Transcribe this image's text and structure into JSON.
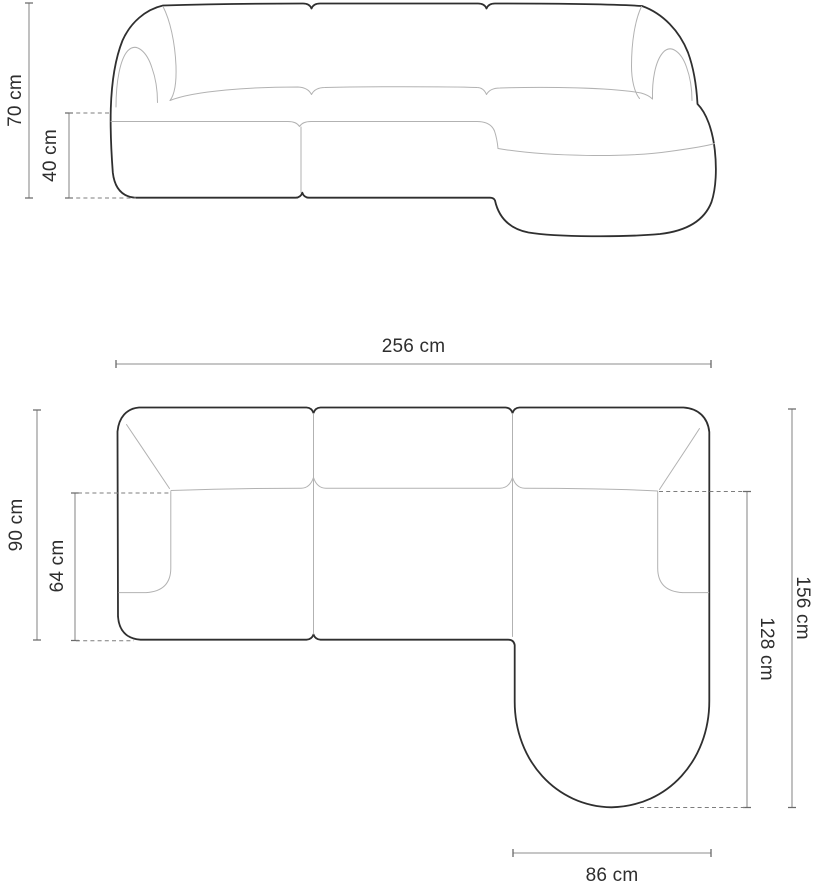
{
  "palette": {
    "background": "#ffffff",
    "outline_dark": "#2f2f2f",
    "line_light": "#b2b2b2",
    "dimension_line": "#8e8e8e",
    "dashed_line": "#7d7d7d",
    "label_text": "#2e2e2e"
  },
  "front_view": {
    "dimensions": {
      "total_height": {
        "label": "70 cm",
        "value": 70,
        "unit": "cm"
      },
      "seat_height": {
        "label": "40 cm",
        "value": 40,
        "unit": "cm"
      }
    }
  },
  "top_view": {
    "dimensions": {
      "total_width": {
        "label": "256 cm",
        "value": 256,
        "unit": "cm"
      },
      "body_depth": {
        "label": "90 cm",
        "value": 90,
        "unit": "cm"
      },
      "seat_depth": {
        "label": "64 cm",
        "value": 64,
        "unit": "cm"
      },
      "total_depth": {
        "label": "156 cm",
        "value": 156,
        "unit": "cm"
      },
      "chaise_depth": {
        "label": "128 cm",
        "value": 128,
        "unit": "cm"
      },
      "chaise_width": {
        "label": "86 cm",
        "value": 86,
        "unit": "cm"
      }
    }
  }
}
